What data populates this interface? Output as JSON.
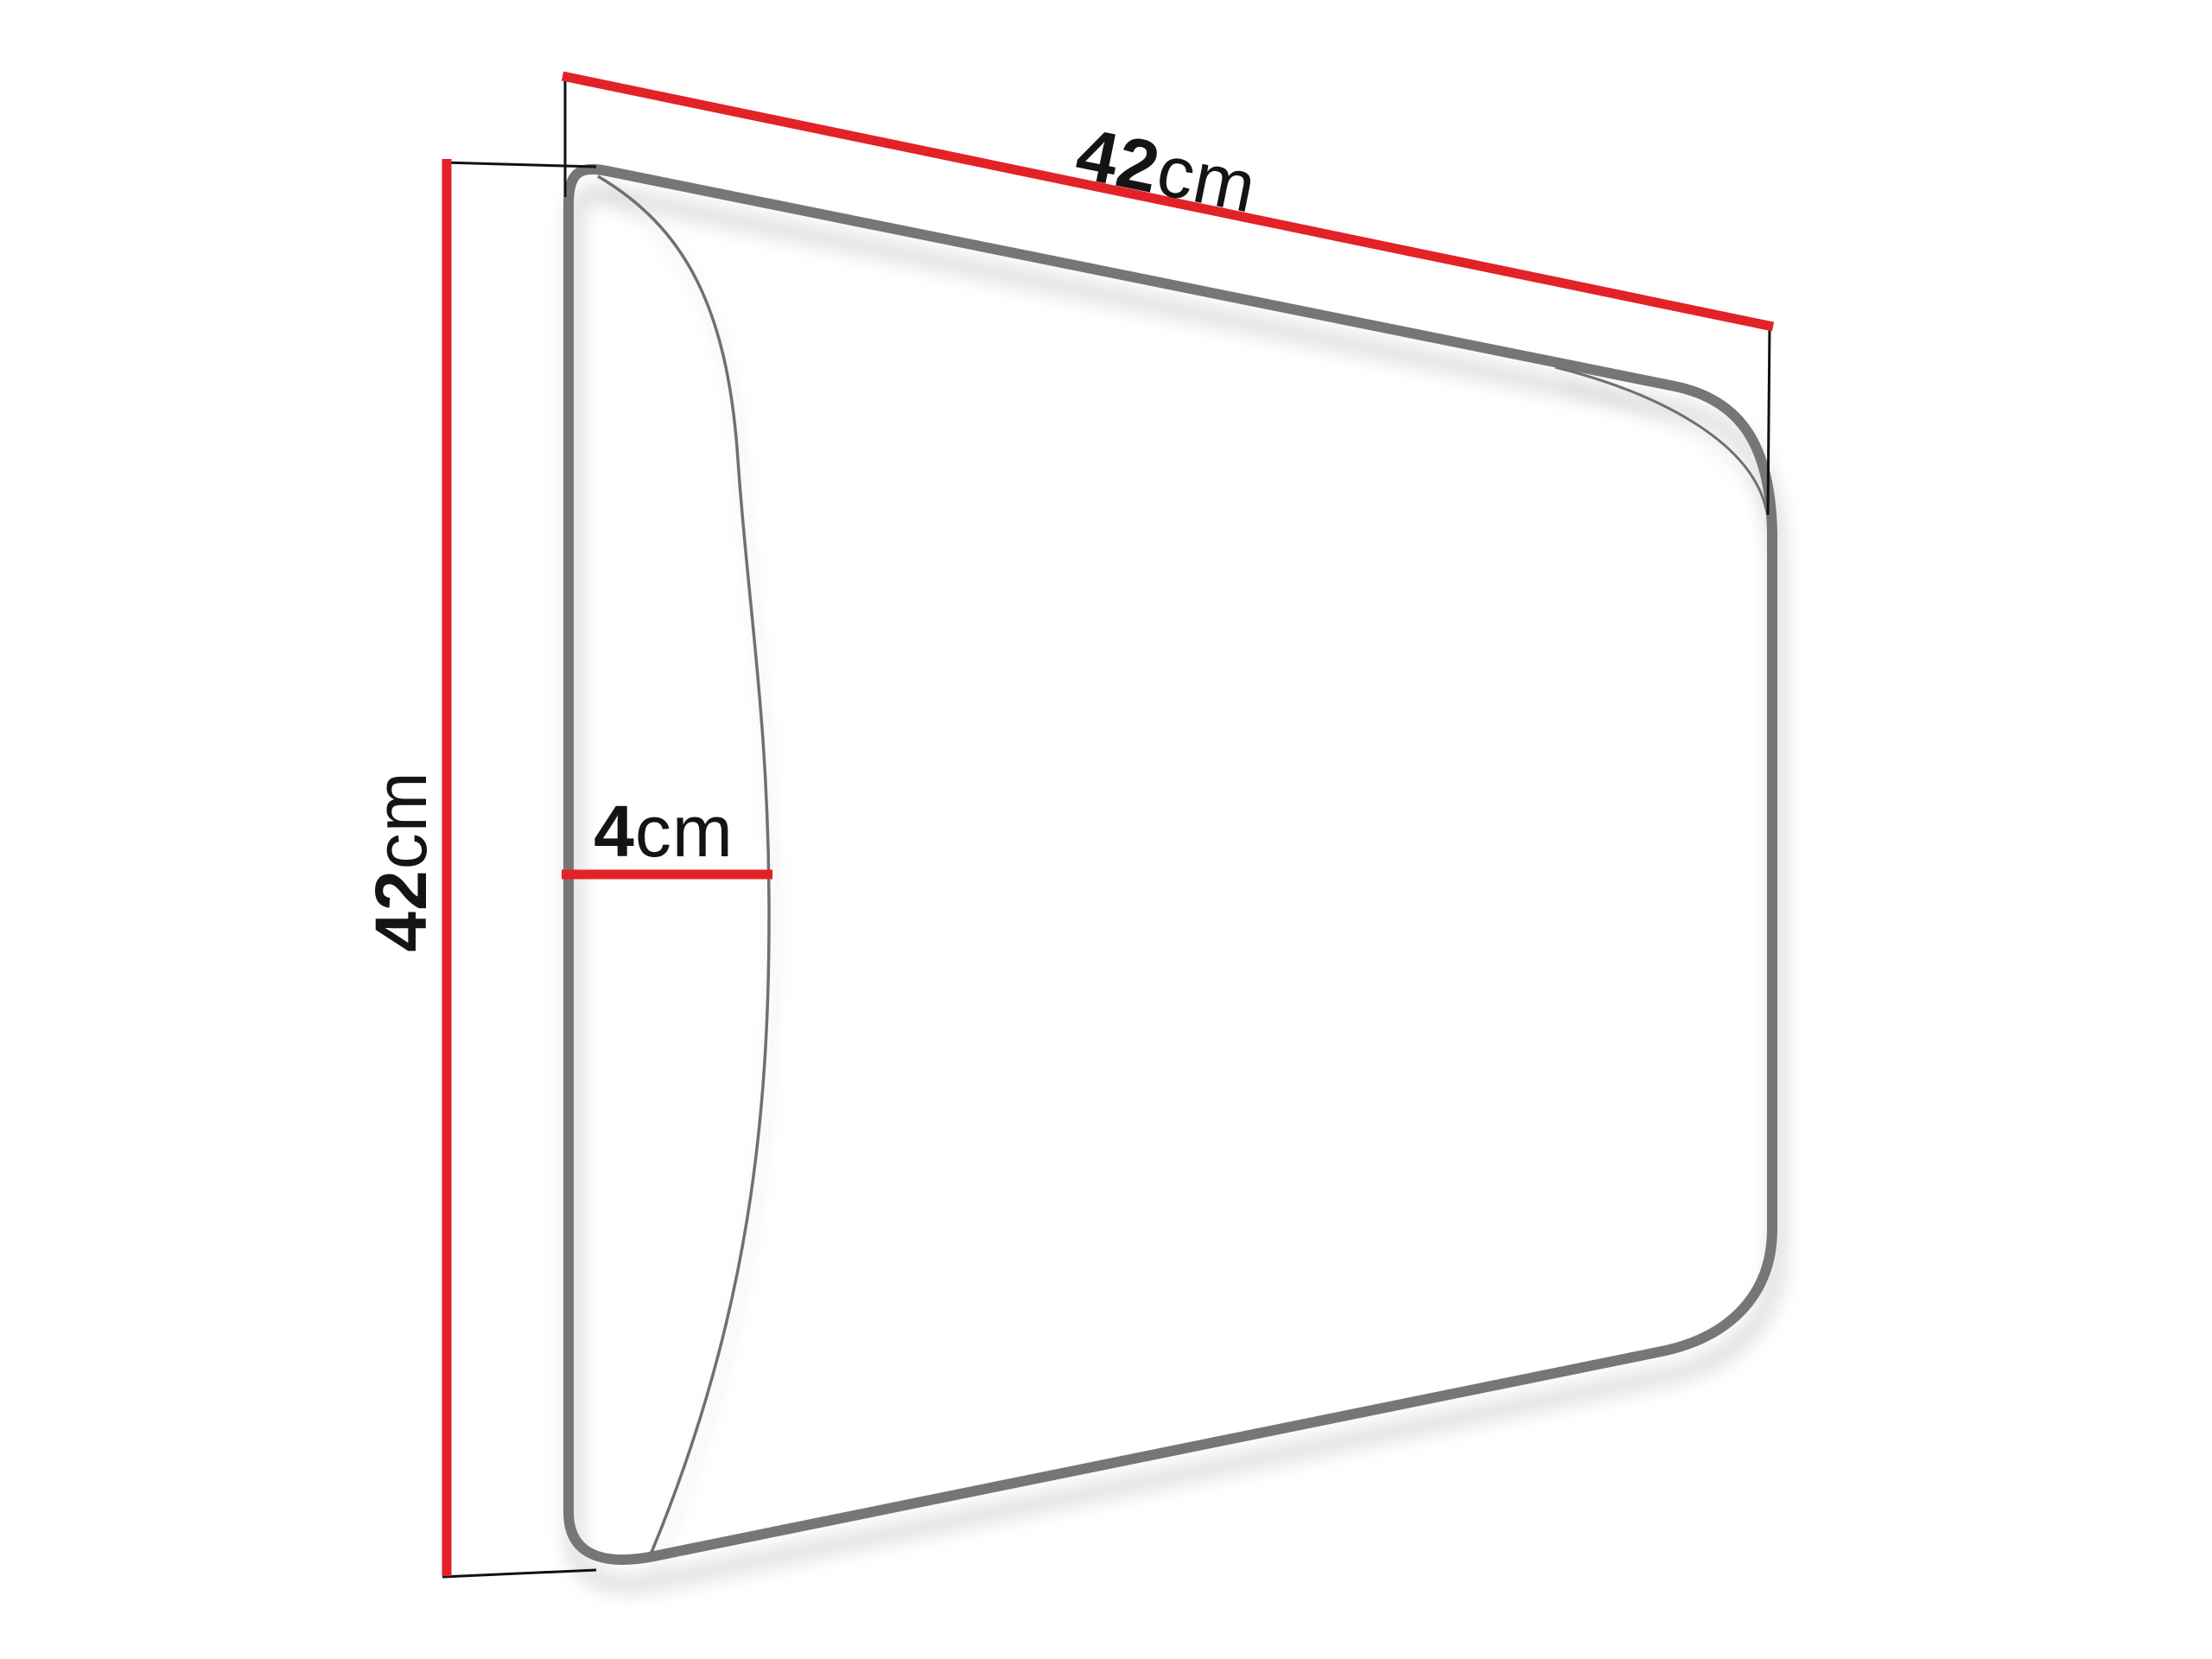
{
  "diagram": {
    "subject": "Upholstered wall panel dimension drawing",
    "unit": "cm",
    "dimensions": {
      "width": {
        "value": "42",
        "unit": "cm"
      },
      "height": {
        "value": "42",
        "unit": "cm"
      },
      "depth": {
        "value": "4",
        "unit": "cm"
      }
    },
    "colors": {
      "dimension_line": "#e32227",
      "extension_line": "#111111",
      "panel_outline": "#767676",
      "panel_front_edge": "#6f6f6f",
      "panel_fill": "#ffffff",
      "label_text": "#141414",
      "background": "#ffffff"
    }
  }
}
